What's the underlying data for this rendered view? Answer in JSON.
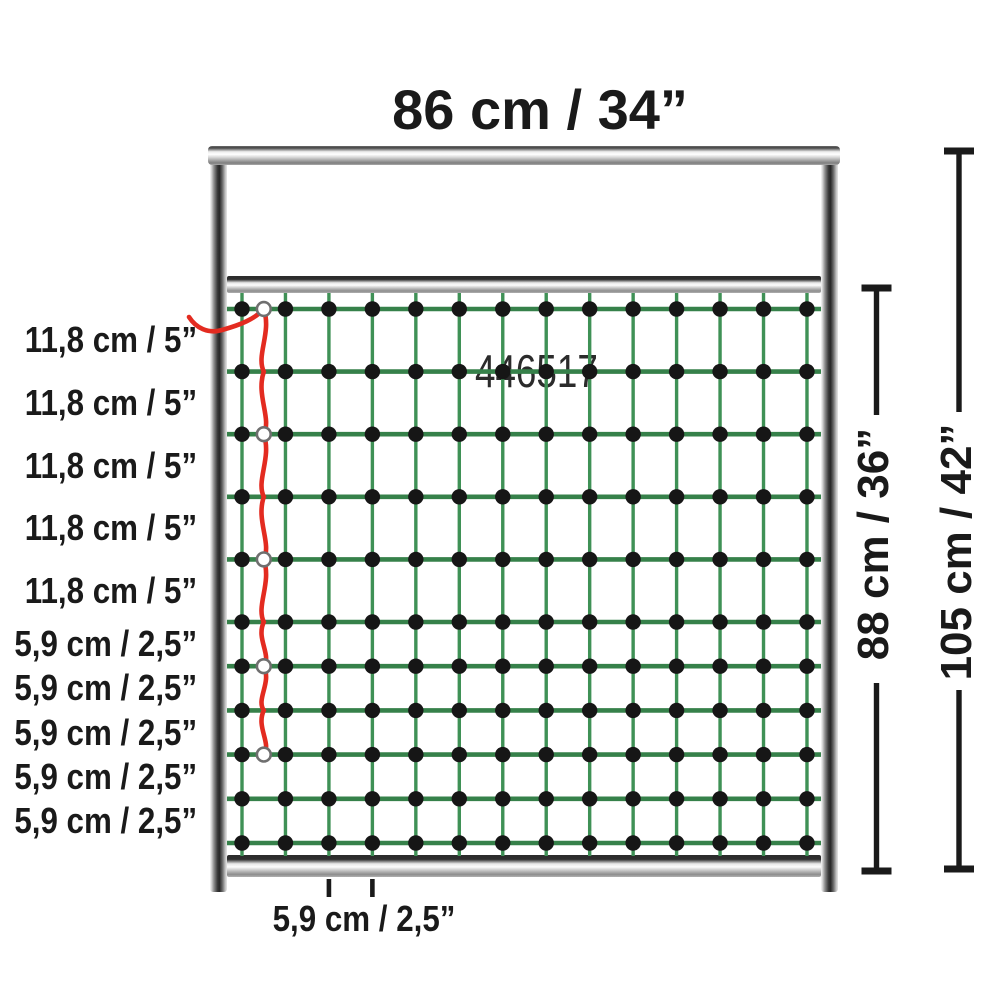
{
  "title": "86 cm / 34”",
  "product_code": "446517",
  "left_labels": [
    "11,8 cm / 5”",
    "11,8 cm / 5”",
    "11,8 cm / 5”",
    "11,8 cm / 5”",
    "11,8 cm / 5”",
    "5,9 cm / 2,5”",
    "5,9 cm / 2,5”",
    "5,9 cm / 2,5”",
    "5,9 cm / 2,5”",
    "5,9 cm / 2,5”"
  ],
  "bottom_label": "5,9 cm / 2,5”",
  "right_dimensions": [
    {
      "label": "88 cm / 36”"
    },
    {
      "label": "105 cm / 42”"
    }
  ],
  "net": {
    "columns": 14,
    "rows": 11,
    "row_group_large": {
      "count": 5,
      "spacing_label": "11,8 cm / 5”"
    },
    "row_group_small": {
      "count": 5,
      "spacing_label": "5,9 cm / 2,5”"
    },
    "mesh_width_label": "5,9 cm / 2,5”",
    "ring_rows": [
      0,
      2,
      4,
      6,
      8
    ]
  },
  "colors": {
    "net_horizontal_green": "#36814A",
    "net_vertical_green": "#3F9156",
    "knot_black": "#161616",
    "cord_red": "#E32B20",
    "ring_gray": "#6F6F6F",
    "dimension_black": "#1A1A1A",
    "text": "#1A1A1A"
  }
}
